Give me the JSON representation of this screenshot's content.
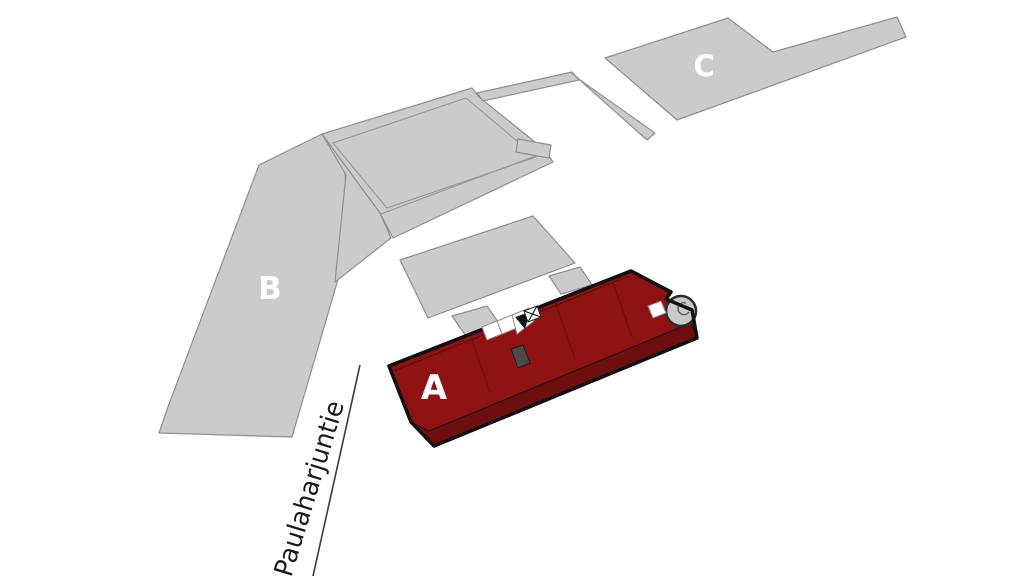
{
  "canvas": {
    "background": "#ffffff"
  },
  "street": {
    "name": "Paulaharjuntie"
  },
  "buildings": {
    "a": {
      "label": "A",
      "highlighted": true
    },
    "b": {
      "label": "B",
      "highlighted": false
    },
    "c": {
      "label": "C",
      "highlighted": false
    }
  },
  "markers": {
    "entrance": {
      "icon": "entrance-triangle-marker"
    },
    "hatch": {
      "icon": "crossed-box-marker"
    },
    "tower": {
      "icon": "round-stair-tower"
    }
  },
  "palette": {
    "building_gray": "#cbcbcb",
    "building_gray_stroke": "#8f8f8f",
    "highlight_red": "#8e1212",
    "highlight_red_dark": "#6f0e0e",
    "outline_black": "#111111",
    "label_white": "#ffffff",
    "street_line_gray": "#3b3b3b",
    "street_text_black": "#1a1a1a",
    "tower_gray": "#c9c9c9"
  }
}
